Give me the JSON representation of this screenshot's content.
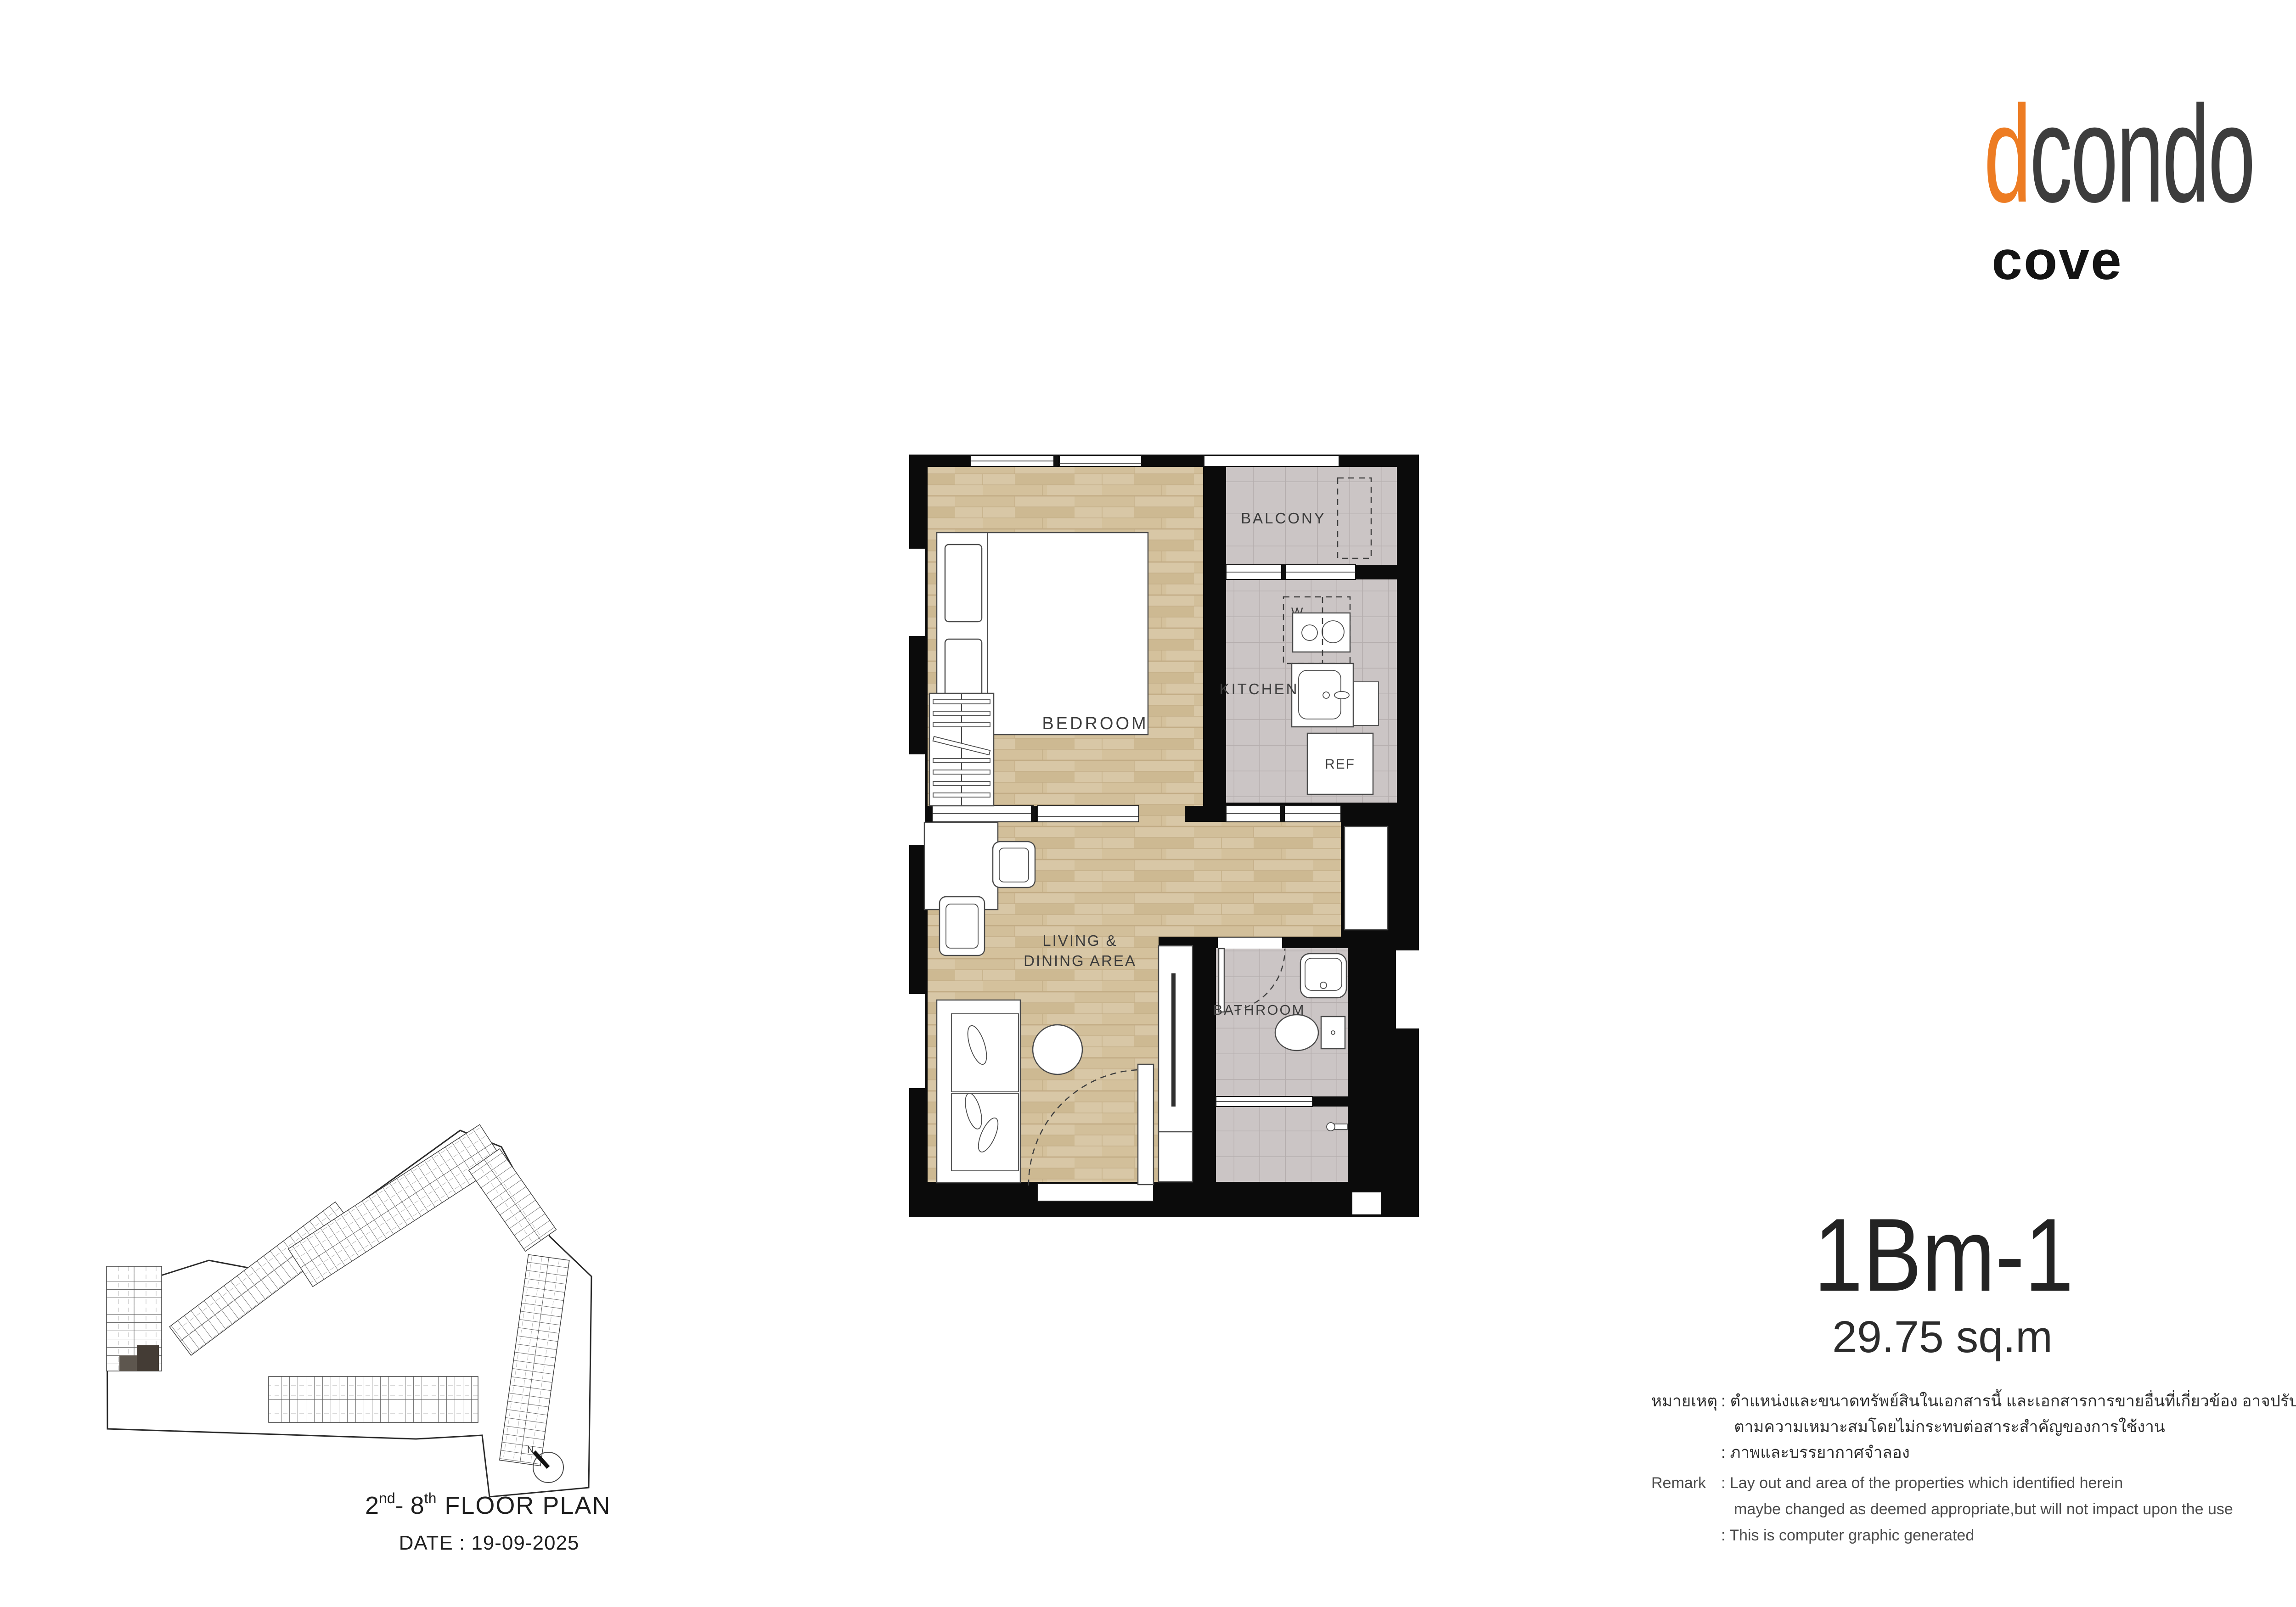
{
  "logo": {
    "brand_prefix": "d",
    "brand_rest": "condo",
    "sub_brand": "cove",
    "accent_color": "#ED7C23"
  },
  "plan": {
    "labels": {
      "balcony": "BALCONY",
      "kitchen": "KITCHEN",
      "bedroom": "BEDROOM",
      "living_line1": "LIVING &",
      "living_line2": "DINING AREA",
      "bathroom": "BATHROOM",
      "ref": "REF",
      "washer": "W"
    },
    "colors": {
      "wall": "#0b0b0b",
      "wood_floor": "#d8c7a6",
      "tile_floor": "#cbc5c5"
    }
  },
  "unit": {
    "name": "1Bm-1",
    "area": "29.75 sq.m"
  },
  "site": {
    "north": "N",
    "floor_base1": "2",
    "floor_sup1": "nd",
    "floor_base2": "- 8",
    "floor_sup2": "th",
    "floor_rest": "FLOOR PLAN",
    "date": "DATE : 19-09-2025"
  },
  "remarks": {
    "thai_label": "หมายเหตุ",
    "thai_line1": ": ตำแหน่งและขนาดทรัพย์สินในเอกสารนี้ และเอกสารการขายอื่นที่เกี่ยวข้อง อาจปรับเปลี่ยนได้",
    "thai_line2": "ตามความเหมาะสมโดยไม่กระทบต่อสาระสำคัญของการใช้งาน",
    "thai_line3": ": ภาพและบรรยากาศจำลอง",
    "en_label": "Remark",
    "en_line1": ": Lay out and area of the properties which identified herein",
    "en_line2": "maybe changed as deemed appropriate,but will not impact upon the use",
    "en_line3": ": This is computer graphic generated"
  }
}
